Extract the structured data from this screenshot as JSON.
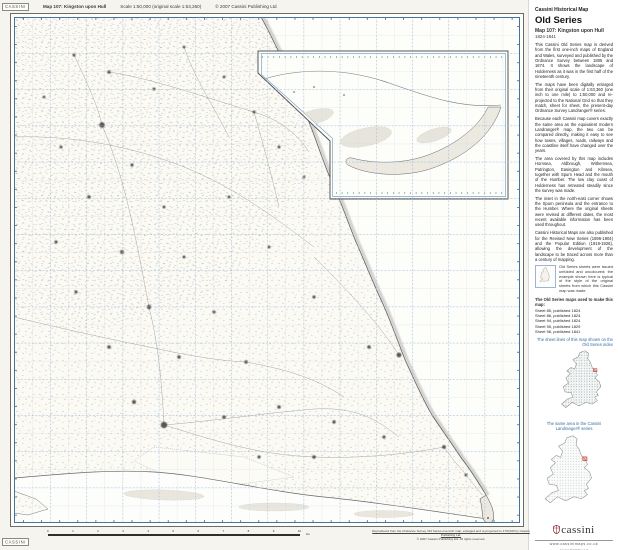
{
  "header": {
    "logo": "CASSINI",
    "map_title": "Map 107: Kingston upon Hull",
    "scale_info": "Scale 1:50,000 (original scale 1:63,360)",
    "copyright": "© 2007 Cassini Publishing Ltd"
  },
  "panel": {
    "kicker": "Cassini Historical Map",
    "series_title": "Old Series",
    "map_title": "Map 107: Kingston upon Hull",
    "date_range": "1824-1841",
    "paragraphs": [
      "This Cassini Old Series map is derived from the first one-inch maps of England and Wales, surveyed and published by the Ordnance Survey between 1805 and 1874. It shows the landscape of Holderness as it was in the first half of the nineteenth century.",
      "The maps have been digitally enlarged from their original scale of 1:63,360 (one inch to one mile) to 1:50,000 and re-projected to the National Grid so that they match, sheet for sheet, the present-day Ordnance Survey Landranger® series.",
      "Because each Cassini map covers exactly the same area as the equivalent modern Landranger® map, the two can be compared directly, making it easy to see how towns, villages, roads, railways and the coastline itself have changed over the years.",
      "The area covered by this map includes Hornsea, Aldbrough, Withernsea, Patrington, Easington and Kilnsea, together with Spurn Head and the mouth of the Humber. The low clay coast of Holderness has retreated steadily since the survey was made.",
      "The inset in the north-east corner shows the Spurn peninsula and the entrance to the Humber. Where the original sheets were revised at different dates, the most recent available information has been used throughout.",
      "Cassini Historical Maps are also published for the Revised New Series (1896-1904) and the Popular Edition (1919-1926), allowing the development of the landscape to be traced across more than a century of mapping."
    ],
    "thumb_caption": "Old Series sheets were issued unfolded and uncoloured; the example shown here is typical of the style of the original sheets from which this Cassini map was made.",
    "sheets_heading": "The Old Series maps used to make this map:",
    "sheets": [
      "Sheet 85, published 1824",
      "Sheet 86, published 1824",
      "Sheet 94, published 1824",
      "Sheet 95, published 1829",
      "Sheet 96, published 1841"
    ],
    "index1_caption": "The sheet lines of this map shown on the Old Series index",
    "index2_caption": "The same area in the Cassini Landranger® series",
    "brand_word": "cassini",
    "website": "www.cassinimaps.co.uk",
    "imprint": [
      "Cassini Publishing Ltd",
      "www.cassinimaps.co.uk",
      "All rights reserved"
    ]
  },
  "footer": {
    "logo": "CASSINI",
    "ruler_labels": [
      "0",
      "1",
      "2",
      "3",
      "4",
      "5",
      "6",
      "7",
      "8",
      "9",
      "10"
    ],
    "ruler_unit": "km",
    "attribution1": "Reproduced from the Ordnance Survey Old Series one-inch map, enlarged and re-projected to 1:50,000 by Cassini Publishing Ltd.",
    "attribution2": "© 2007 Cassini Publishing Ltd. All rights reserved."
  },
  "colors": {
    "grid_blue": "#c2d5e6",
    "border_blue": "#49739e",
    "caption_blue": "#3a6da0",
    "paper": "#fbfaf4"
  }
}
